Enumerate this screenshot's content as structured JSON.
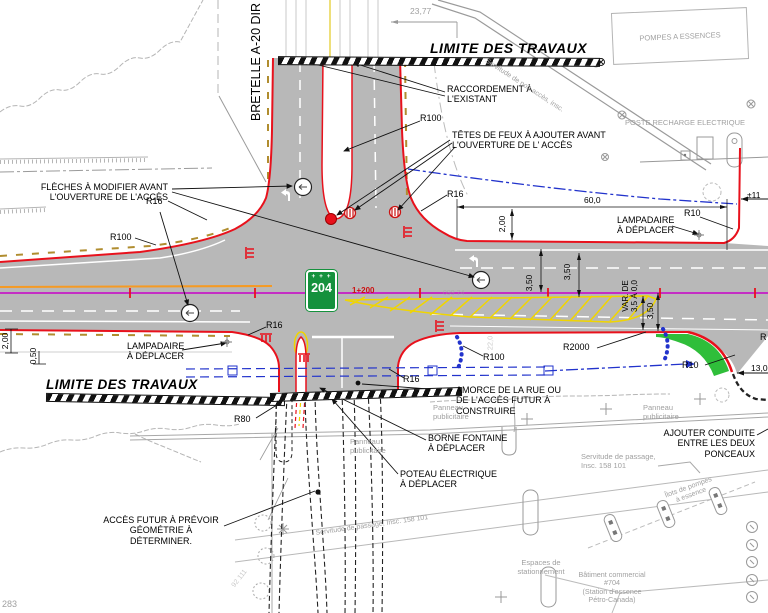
{
  "colors": {
    "road_gray": "#b8b8b8",
    "curb_red": "#e8111c",
    "marking_yellow": "#f0d500",
    "centerline_magenta": "#c800c8",
    "conduit_blue": "#2233cc",
    "landscaping_green": "#2fbe3a",
    "existing_gray": "#a0a0a0",
    "utility_orange": "#f59a23"
  },
  "roads": {
    "ramp_label": "BRETELLE A-20 DIR",
    "route_shield_number": "204",
    "route_shield_crowns": "+ + +",
    "chainage": "1+200",
    "station_faint": "099  74",
    "lot_faint": "92 111",
    "note_left_edge": "283"
  },
  "work_limits": {
    "top": "LIMITE DES TRAVAUX",
    "bottom": "LIMITE DES TRAVAUX"
  },
  "annotations": {
    "raccordement": "RACCORDEMENT À\nL'EXISTANT",
    "tetes_de_feux": "TÊTES DE FEUX À AJOUTER AVANT\nL'OUVERTURE DE L' ACCÈS",
    "fleches": "FLÈCHES À MODIFIER AVANT\nL'OUVERTURE DE L'ACCÈS",
    "lampadaire_droit": "LAMPADAIRE\nÀ DÉPLACER",
    "lampadaire_gauche": "LAMPADAIRE\nÀ DÉPLACER",
    "amorce": "AMORCE DE LA RUE OU\nDE L'ACCÈS FUTUR À\nCONSTRUIRE",
    "borne_fontaine": "BORNE FONTAINE\nÀ DÉPLACER",
    "poteau_electrique": "POTEAU ÉLECTRIQUE\nÀ DÉPLACER",
    "acces_futur": "ACCÈS FUTUR À PRÉVOIR\nGÉOMÉTRIE À DÉTERMINER.",
    "ajouter_conduite": "AJOUTER CONDUITE\nENTRE LES DEUX\nPONCEAUX"
  },
  "radius_labels": {
    "r100_top": "R100",
    "r16_nw": "R16",
    "r16_ne": "R16",
    "r100_w": "R100",
    "r16_sw": "R16",
    "r100_s": "R100",
    "r2000": "R2000",
    "r16_s": "R16",
    "r10_ne": "R10",
    "r10_se": "R10",
    "r80": "R80",
    "r_clipped": "R"
  },
  "dimensions": {
    "d23_77": "23,77",
    "d60": "60,0",
    "d2_est": "2,00",
    "d350_a": "3,50",
    "d350_b": "3,50",
    "var_de": "VAR. DE\n3,5 À 0,0",
    "d350_c": "3,50",
    "d2_ouest": "2,00",
    "d0_50": "0,50",
    "d22": "22,0",
    "d11": "±11",
    "d13": "13,0"
  },
  "existing_features": {
    "pompes": "POMPES A ESSENCES",
    "poste_recharge": "POSTE RECHARGE ELECTRIQUE",
    "servitude_non_acces": "Servitude de non-accès, insc.",
    "panneau_1": "Panneau\npublicitaire",
    "panneau_2": "Panneau\npublicitaire",
    "panneau_3": "Panneau\npublicitaire",
    "servitude_1": "Servitude de passage,\nInsc. 158 101",
    "servitude_2": "Servitude de passage, Insc. 158 101",
    "espaces": "Espaces de\nstationnement",
    "ilots": "Îlots de pompes\nà essence",
    "batiment": "Bâtiment commercial\n#704\n(Station d'essence\nPétro-Canada)"
  }
}
